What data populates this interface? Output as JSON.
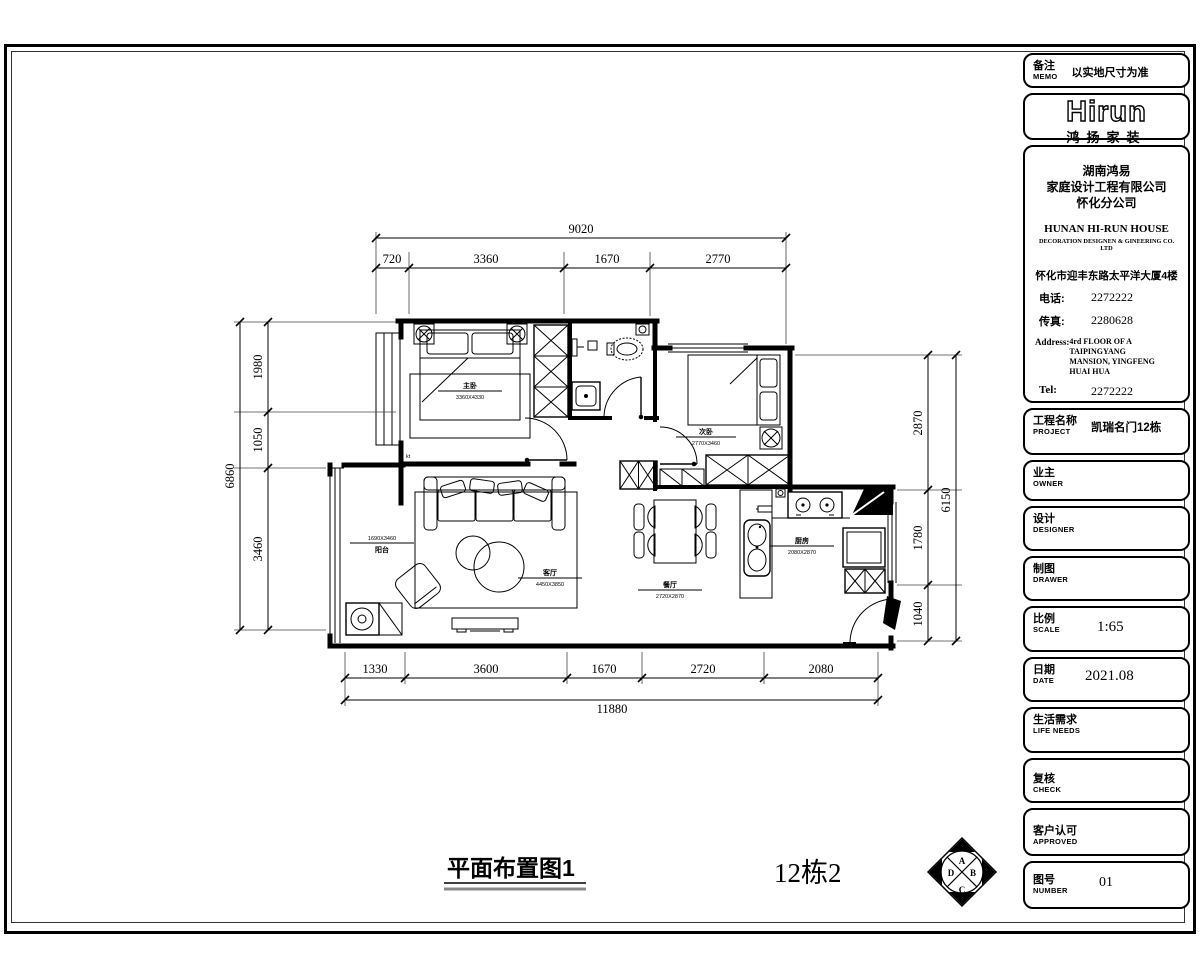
{
  "drawing": {
    "title": "平面布置图1",
    "unit_label": "12栋2"
  },
  "memo": {
    "label_cn": "备注",
    "label_en": "MEMO",
    "value": "以实地尺寸为准"
  },
  "logo": {
    "brand": "Hirun",
    "brand_cn": "鸿扬家装"
  },
  "company": {
    "cn1": "湖南鸿易",
    "cn2": "家庭设计工程有限公司",
    "cn3": "怀化分公司",
    "en1": "HUNAN HI-RUN HOUSE",
    "en2": "DECORATION DESIGNEN & GINEERING CO. LTD",
    "addr_cn": "怀化市迎丰东路太平洋大厦4楼",
    "phone_label": "电话:",
    "phone": "2272222",
    "fax_label": "传真:",
    "fax": "2280628",
    "addr_label": "Address:",
    "addr1": "4rd FLOOR OF A TAIPINGYANG",
    "addr2": "MANSION, YINGFENG",
    "addr3": "HUAI HUA",
    "tel_label": "Tel:",
    "tel": "2272222",
    "fax2_label": "Fax:",
    "fax2": "2280628"
  },
  "fields": {
    "project": {
      "cn": "工程名称",
      "en": "PROJECT",
      "value": "凯瑞名门12栋"
    },
    "owner": {
      "cn": "业主",
      "en": "OWNER",
      "value": ""
    },
    "designer": {
      "cn": "设计",
      "en": "DESIGNER",
      "value": ""
    },
    "drawer": {
      "cn": "制图",
      "en": "DRAWER",
      "value": ""
    },
    "scale": {
      "cn": "比例",
      "en": "SCALE",
      "value": "1:65"
    },
    "date": {
      "cn": "日期",
      "en": "DATE",
      "value": "2021.08"
    },
    "life": {
      "cn": "生活需求",
      "en": "LIFE  NEEDS",
      "value": ""
    },
    "check": {
      "cn": "复核",
      "en": "CHECK",
      "value": ""
    },
    "approved": {
      "cn": "客户认可",
      "en": "APPROVED",
      "value": ""
    },
    "number": {
      "cn": "图号",
      "en": "NUMBER",
      "value": "01"
    }
  },
  "dimensions": {
    "top": {
      "total": "9020",
      "segments": [
        "720",
        "3360",
        "1670",
        "2770"
      ]
    },
    "bottom": {
      "total": "11880",
      "segments": [
        "1330",
        "3600",
        "1670",
        "2720",
        "2080"
      ]
    },
    "left": {
      "total": "6860",
      "segments": [
        "1980",
        "1050",
        "3460"
      ]
    },
    "right": {
      "total": "6150",
      "segments": [
        "2870",
        "1780",
        "1040"
      ]
    }
  },
  "rooms": {
    "master": {
      "name": "主卧",
      "dim": "3360X4330"
    },
    "second": {
      "name": "次卧",
      "dim": "2770X3460"
    },
    "living": {
      "name": "客厅",
      "dim": "4450X3850"
    },
    "dining": {
      "name": "餐厅",
      "dim": "2720X2870"
    },
    "kitchen": {
      "name": "厨房",
      "dim": "2080X2870"
    },
    "balcony": {
      "name": "阳台",
      "dim": "1690X3460"
    }
  },
  "compass": {
    "a": "A",
    "b": "B",
    "c": "C",
    "d": "D"
  },
  "misc": {
    "kt": "kt"
  },
  "colors": {
    "line": "#000000",
    "gray": "#888888"
  }
}
